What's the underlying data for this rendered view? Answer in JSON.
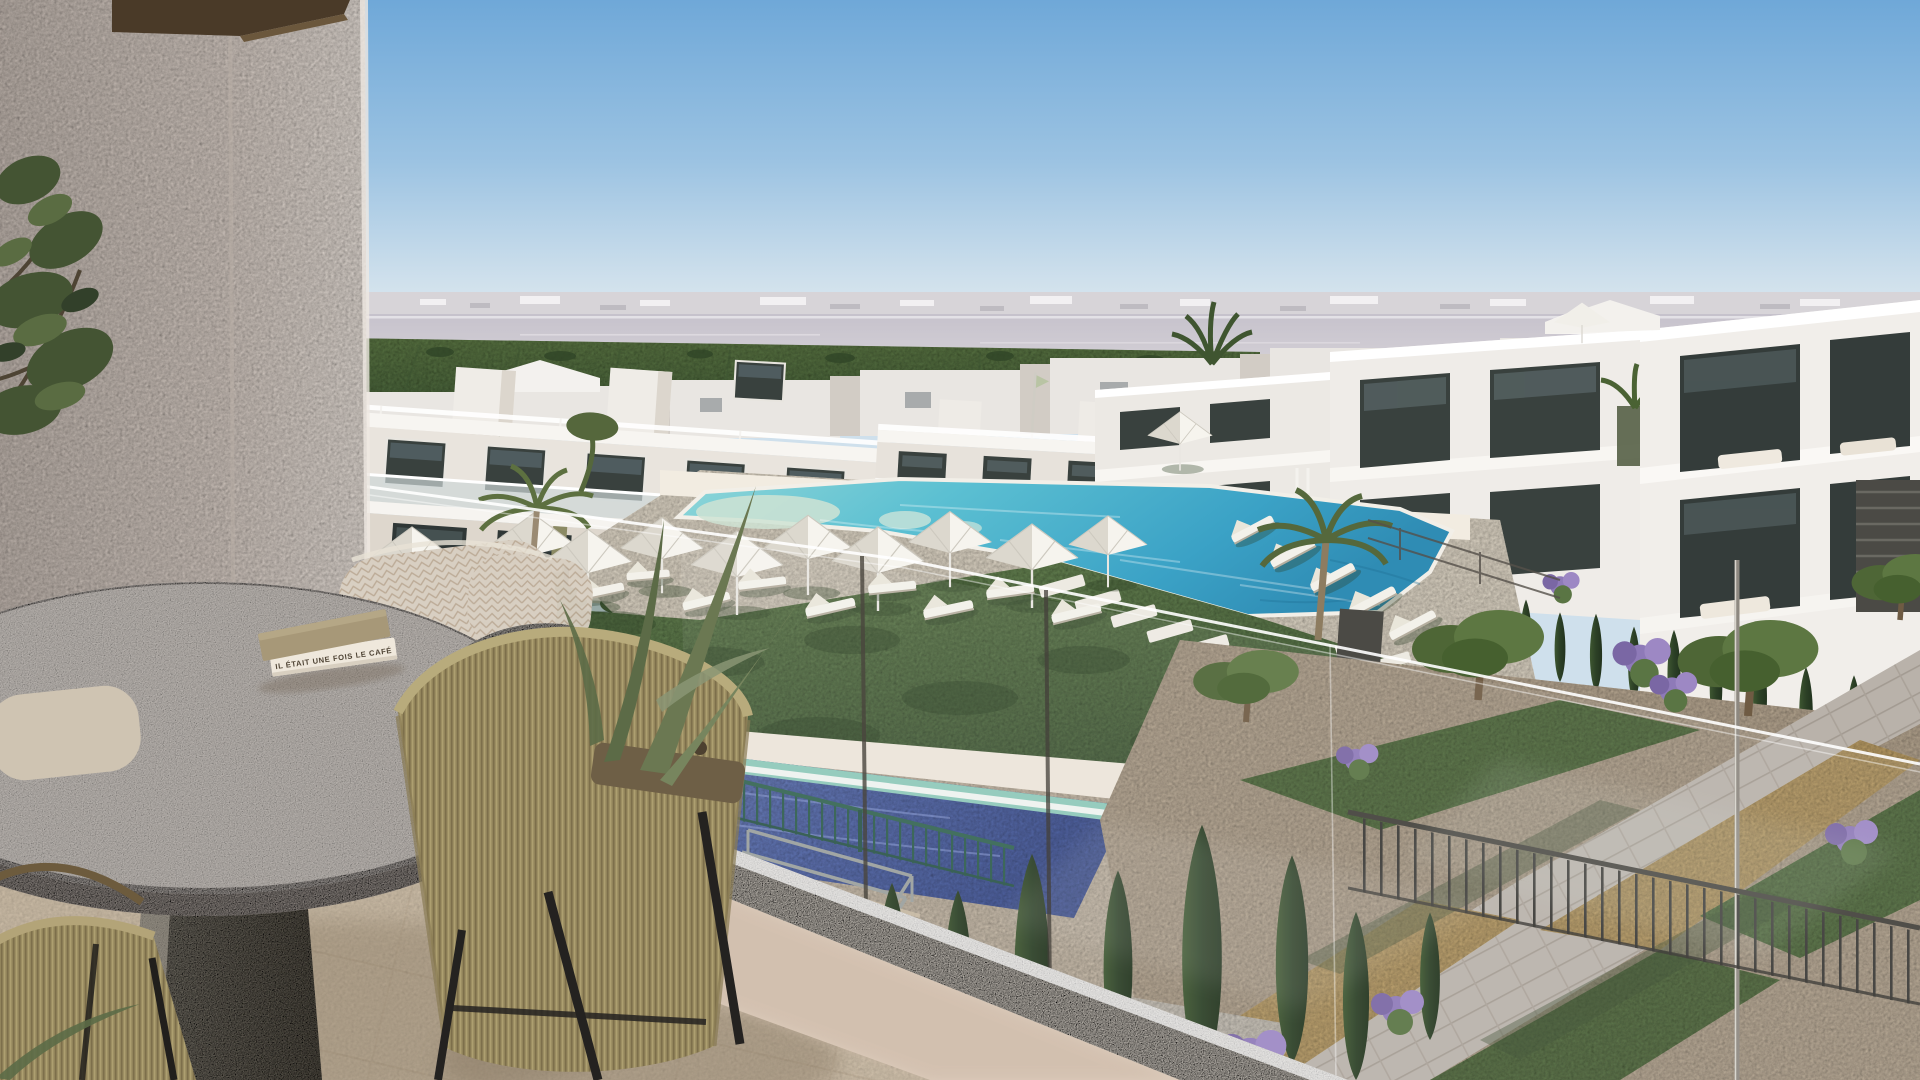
{
  "scene": {
    "kind": "photorealistic-architectural-render",
    "description": "View from a private apartment balcony over a resort-style residential complex: round stone table with a book, rope armchairs, glass balustrade, lawn with white parasols and sun loungers, large turquoise lagoon pool, a second lower pool, white modern apartment blocks, gardens with cypresses and purple shrubs, salt lagoon and distant town on the horizon under a clear blue sky.",
    "book_title": "IL ÉTAIT UNE FOIS LE CAFÉ",
    "palette": {
      "sky_top": "#6fa8d8",
      "sky_horizon": "#e9f0f2",
      "distant_city": "#d7d4d8",
      "lagoon_water": "#c9c5cf",
      "green_fields": "#56713f",
      "building_white": "#f1efeb",
      "building_shade": "#d9d2c8",
      "window_glass": "#39413e",
      "accent_olive_panel": "#8b8a64",
      "pool_turquoise": "#49b4cf",
      "pool_deep": "#2f8cb4",
      "lower_pool_blue": "#5d74bd",
      "lawn_green": "#5f7d49",
      "umbrella_white": "#f4f2ec",
      "deck_sand": "#e4d9c4",
      "stone_table_grey": "#ccc5c0",
      "rope_olive": "#97895f",
      "cushion_beige": "#d8cfc2",
      "balcony_wall": "#d9cec6",
      "soffit_brown": "#4a3a28",
      "floor_tile": "#d6c6af",
      "parapet_white": "#f2ebe1",
      "metal_railing_dark": "#3b3a36",
      "pool_fence_green": "#356653",
      "gravel_tan": "#c8a96e",
      "flower_purple": "#8e7ab8"
    },
    "elements": [
      "sky",
      "horizon-town",
      "salt-lagoon",
      "green-fields",
      "distant-rooftops",
      "left-apartment-block",
      "center-apartment-block",
      "right-townhouse-row",
      "main-pool",
      "pool-deck",
      "lawn",
      "parasols",
      "sun-loungers",
      "stepping-stones",
      "lower-pool",
      "pool-fence",
      "stair-handrails",
      "garden-paths",
      "olive-trees",
      "cypress-trees",
      "purple-shrubs",
      "lamp-post",
      "garden-railing",
      "balcony-glass",
      "balcony-parapet",
      "balcony-floor",
      "balcony-wall",
      "ceiling-soffit",
      "olive-branch",
      "stone-table",
      "book",
      "rope-armchairs",
      "knit-cushions",
      "palm-fronds"
    ]
  }
}
